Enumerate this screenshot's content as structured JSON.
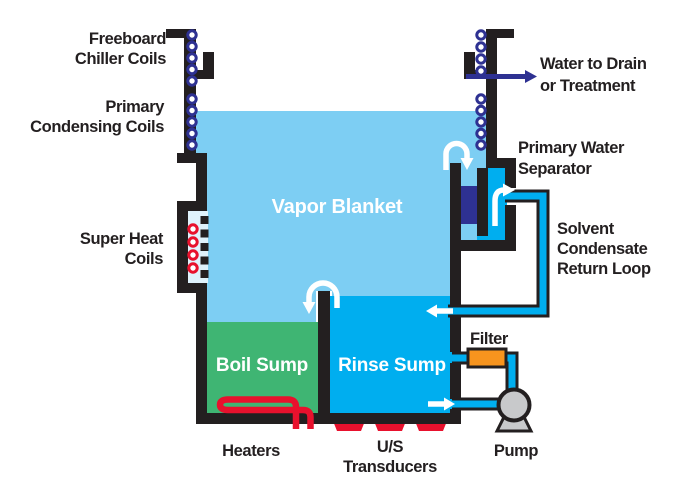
{
  "title": "Vapor Degreaser System Diagram",
  "labels": {
    "freeboard_chiller_l1": "Freeboard",
    "freeboard_chiller_l2": "Chiller Coils",
    "primary_condensing_l1": "Primary",
    "primary_condensing_l2": "Condensing Coils",
    "super_heat_l1": "Super Heat",
    "super_heat_l2": "Coils",
    "water_drain_l1": "Water to Drain",
    "water_drain_l2": "or Treatment",
    "separator_l1": "Primary Water",
    "separator_l2": "Separator",
    "return_loop_l1": "Solvent",
    "return_loop_l2": "Condensate",
    "return_loop_l3": "Return Loop",
    "filter": "Filter",
    "pump": "Pump",
    "heaters": "Heaters",
    "transducers_l1": "U/S",
    "transducers_l2": "Transducers"
  },
  "regions": {
    "vapor_blanket": "Vapor Blanket",
    "boil_sump": "Boil Sump",
    "rinse_sump": "Rinse Sump"
  },
  "colors": {
    "vapor": "#7DCEF3",
    "cyan": "#00AEEF",
    "green": "#3FB573",
    "navy": "#2E3192",
    "red": "#E8112D",
    "orange": "#F7941E",
    "gray": "#C8C9CB",
    "pale": "#DFF2FC",
    "ink": "#231F20"
  }
}
